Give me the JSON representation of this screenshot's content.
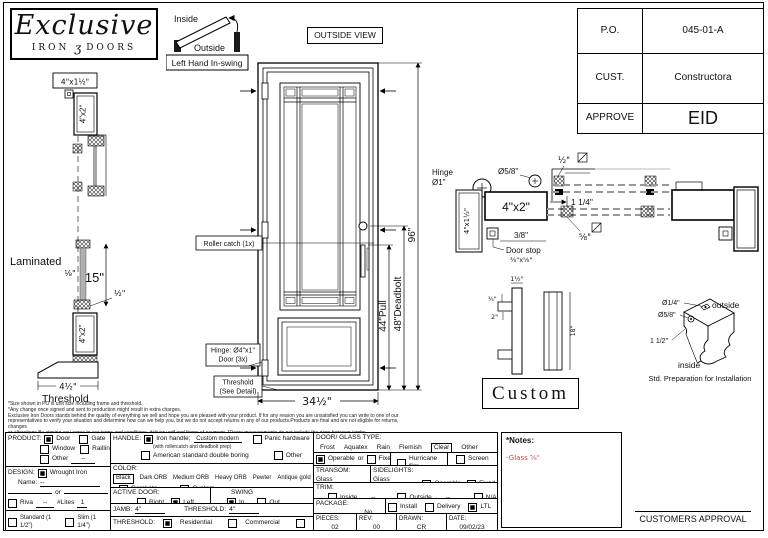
{
  "sheet": {
    "logo": {
      "title": "Exclusive",
      "iron": "IRON",
      "ornament": "ʒ",
      "doors": "DOORS"
    },
    "swing": {
      "inside": "Inside",
      "outside": "Outside",
      "caption": "Left Hand In-swing"
    },
    "outside_view": "OUTSIDE VIEW",
    "titleblock": {
      "po_label": "P.O.",
      "po": "045-01-A",
      "cust_label": "CUST.",
      "cust": "Constructora",
      "approve_label": "APPROVE",
      "approve": "EID"
    }
  },
  "section": {
    "top_label": "4\"x1½\"",
    "jamb1": "4\"x2\"",
    "jamb2": "4\"x2\"",
    "laminated": "Laminated",
    "glass_thk": "⅛\"",
    "h15": "15\"",
    "half": "½\"",
    "thr_w": "4½\"",
    "threshold": "Threshold"
  },
  "door": {
    "roller": "Roller catch (1x)",
    "hinge1": "Hinge: Ø4\"x1\"",
    "hinge2": "Door (3x)",
    "th1": "Threshold",
    "th2": "(See Detail)",
    "w": "34½\"",
    "pull": "44\"Pull",
    "deadbolt": "48\"Deadbolt",
    "h": "96\""
  },
  "plan": {
    "hinge": "Hinge",
    "hinge_d": "Ø1\"",
    "d58": "Ø5/8\"",
    "jamb": "4\"x2\"",
    "leaf": "4\"x1½\"",
    "ds38": "3/8\"",
    "doorstop": "Door stop",
    "ds_size": "⅜\"x⅝\"",
    "half": "½\"",
    "d114": "1 1/4\"",
    "f58": "⅝\""
  },
  "handle": {
    "top": "1½\"",
    "a": "¾\"",
    "b": "2\"",
    "len": "18\"",
    "custom": "Custom"
  },
  "prep": {
    "d14": "Ø1/4\"",
    "d58": "Ø5/8\"",
    "d112": "1 1/2\"",
    "outside": "outside",
    "inside": "inside",
    "caption": "Std. Preparation for Installation"
  },
  "fineprint": {
    "l1": "*Size shown in PO is unit size including frame and threshold.",
    "l2": "*Any change once signed and sent to production might result in extra charges.",
    "l3": "Exclusive Iron Doors stands behind the quality of everything we sell and hope you are pleased with your product. If for any reason you are unsatisfied you can write to one of our",
    "l4": "representatives to verify your situation and determine how can we help you, but we do not accept returns in any of our products.Products are final and are not eligible for returns, changes",
    "l5": "or alterations.By signing you agree to our terms and conditions, delivery pdf and forms of payment. *Doors measurements do not include the gaps between jambs"
  },
  "form": {
    "product": {
      "label": "PRODUCT:",
      "door": "Door",
      "gate": "Gate",
      "window": "Window",
      "railing": "Railling",
      "other": "Other",
      "other_val": "--"
    },
    "design": {
      "label": "DESIGN:",
      "wrought": "Wrought Iron",
      "name_label": "Name:",
      "name_val": "--",
      "or": "or",
      "riva": "Riva",
      "riva_val": "--",
      "lites": "#Lites",
      "lites_val": "1",
      "standard": "Standard (1 1/2\")",
      "slim": "Slim (1 1/4\")"
    },
    "handle": {
      "label": "HANDLE:",
      "iron": "Iron handle;",
      "iron_val": "Custom modern",
      "iron_note": "(with rollercatch and deadbolt prep)",
      "american": "American standard double boring",
      "panic": "Panic hardware",
      "other": "Other"
    },
    "color": {
      "label": "COLOR:",
      "selected": "Black",
      "c1": "Dark ORB",
      "c2": "Medium ORB",
      "c3": "Heavy ORB",
      "c4": "Pewter",
      "c5": "Antique gold",
      "cerakote": "Cerakote",
      "custom": "Custom"
    },
    "active": {
      "label": "ACTIVE DOOR:",
      "right": "Right",
      "left": "Left",
      "swing": "SWING",
      "in": "In",
      "out": "Out"
    },
    "jamb": {
      "label": "JAMB:",
      "val": "4\"",
      "thr_label": "THRESHOLD:",
      "thr_val": "4\""
    },
    "threshold": {
      "label": "THRESHOLD:",
      "res": "Residential",
      "com": "Commercial",
      "na": "N/A"
    },
    "glass": {
      "label": "DOOR/ GLASS TYPE:",
      "frost": "Frost",
      "aquatex": "Aquatex",
      "rain": "Rain",
      "flemish": "Flemish",
      "clear": "Clear",
      "other": "Other",
      "operable": "Operable",
      "or": "or",
      "fixed": "Fixed",
      "hurricane": "Hurricane film",
      "screen": "Screen"
    },
    "transom": {
      "label": "TRANSOM:",
      "glass_type": "Glass type:",
      "val": "--"
    },
    "sidelights": {
      "label": "SIDELIGHTS:",
      "glass_type": "Glass type:",
      "val": "--",
      "operable": "Operable",
      "fixed": "Fixed"
    },
    "trim": {
      "label": "TRIM:",
      "inside": "Inside",
      "inside_val": "--",
      "outside": "Outside",
      "outside_val": "--",
      "na": "N/A"
    },
    "package": {
      "label": "PACKAGE:",
      "box": "Box",
      "nobox": "No box",
      "install": "Install",
      "delivery": "Delivery",
      "ltl": "LTL"
    },
    "meta": {
      "pieces_label": "PIECES:",
      "pieces": "02",
      "rev_label": "REV:",
      "rev": "00",
      "drawn_label": "DRAWN:",
      "drawn": "CR",
      "date_label": "DATE:",
      "date": "09/02/23"
    }
  },
  "notes": {
    "title": "*Notes:",
    "glass": "-Glass ⅝\""
  },
  "approval": "CUSTOMERS APPROVAL"
}
